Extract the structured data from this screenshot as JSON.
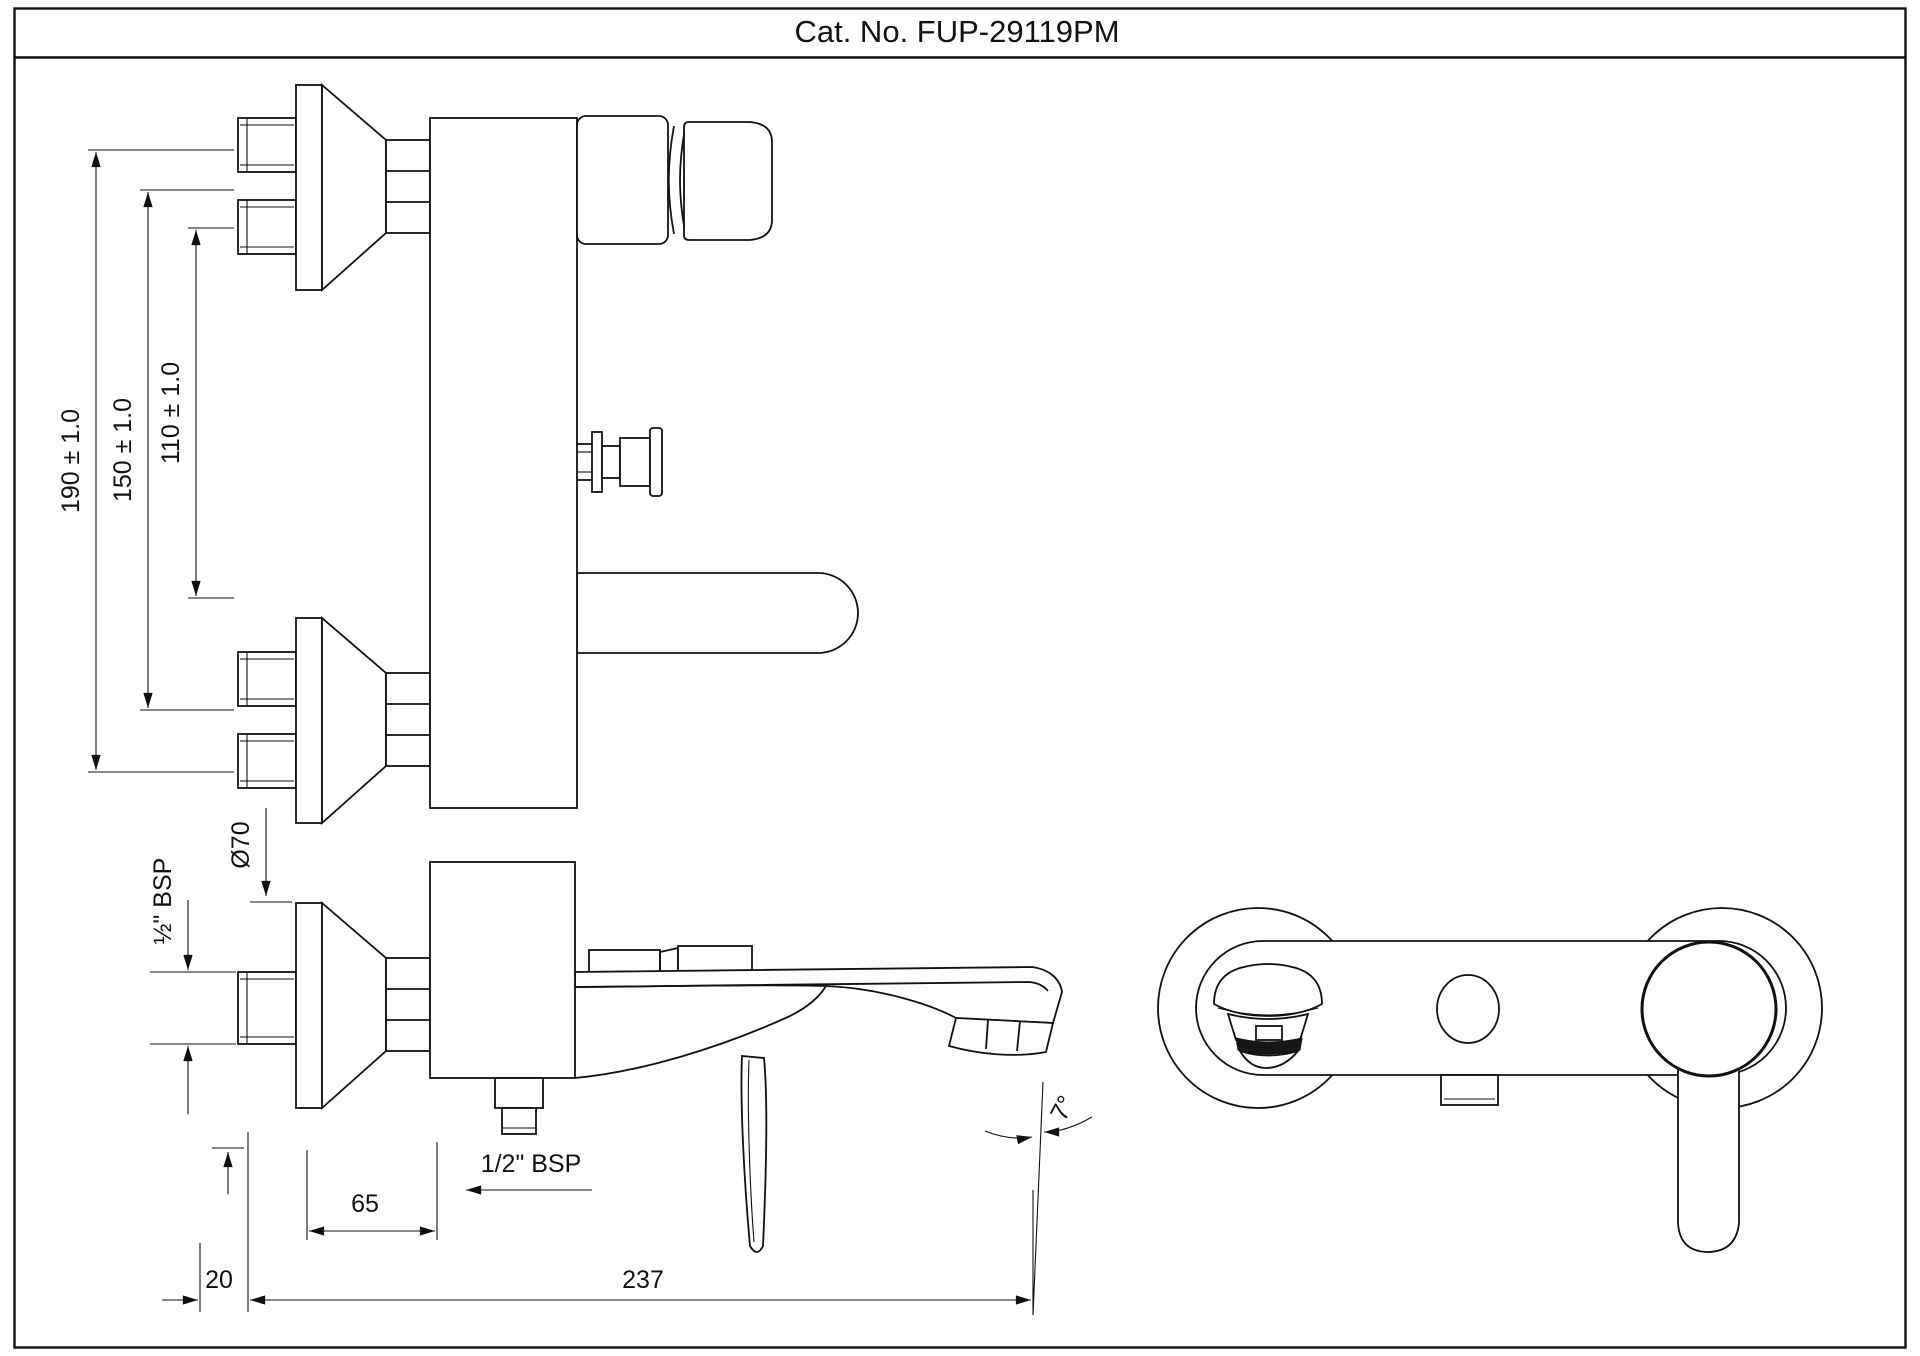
{
  "title": "Cat. No. FUP-29119PM",
  "colors": {
    "line": "#111111",
    "background": "#ffffff"
  },
  "dims": {
    "d190": "190 ± 1.0",
    "d150": "150 ± 1.0",
    "d110": "110 ± 1.0",
    "dia70": "Ø70",
    "bsp_inlet": "½\" BSP",
    "d65": "65",
    "d20": "20",
    "d237": "237",
    "bsp_spout": "1/2\" BSP",
    "angle7": "7°"
  },
  "views": {
    "side_elevation": {
      "name": "side elevation with inlet centers"
    },
    "side_profile": {
      "name": "side profile with spout and lever"
    },
    "front": {
      "name": "front view with escutcheons and handle"
    }
  }
}
